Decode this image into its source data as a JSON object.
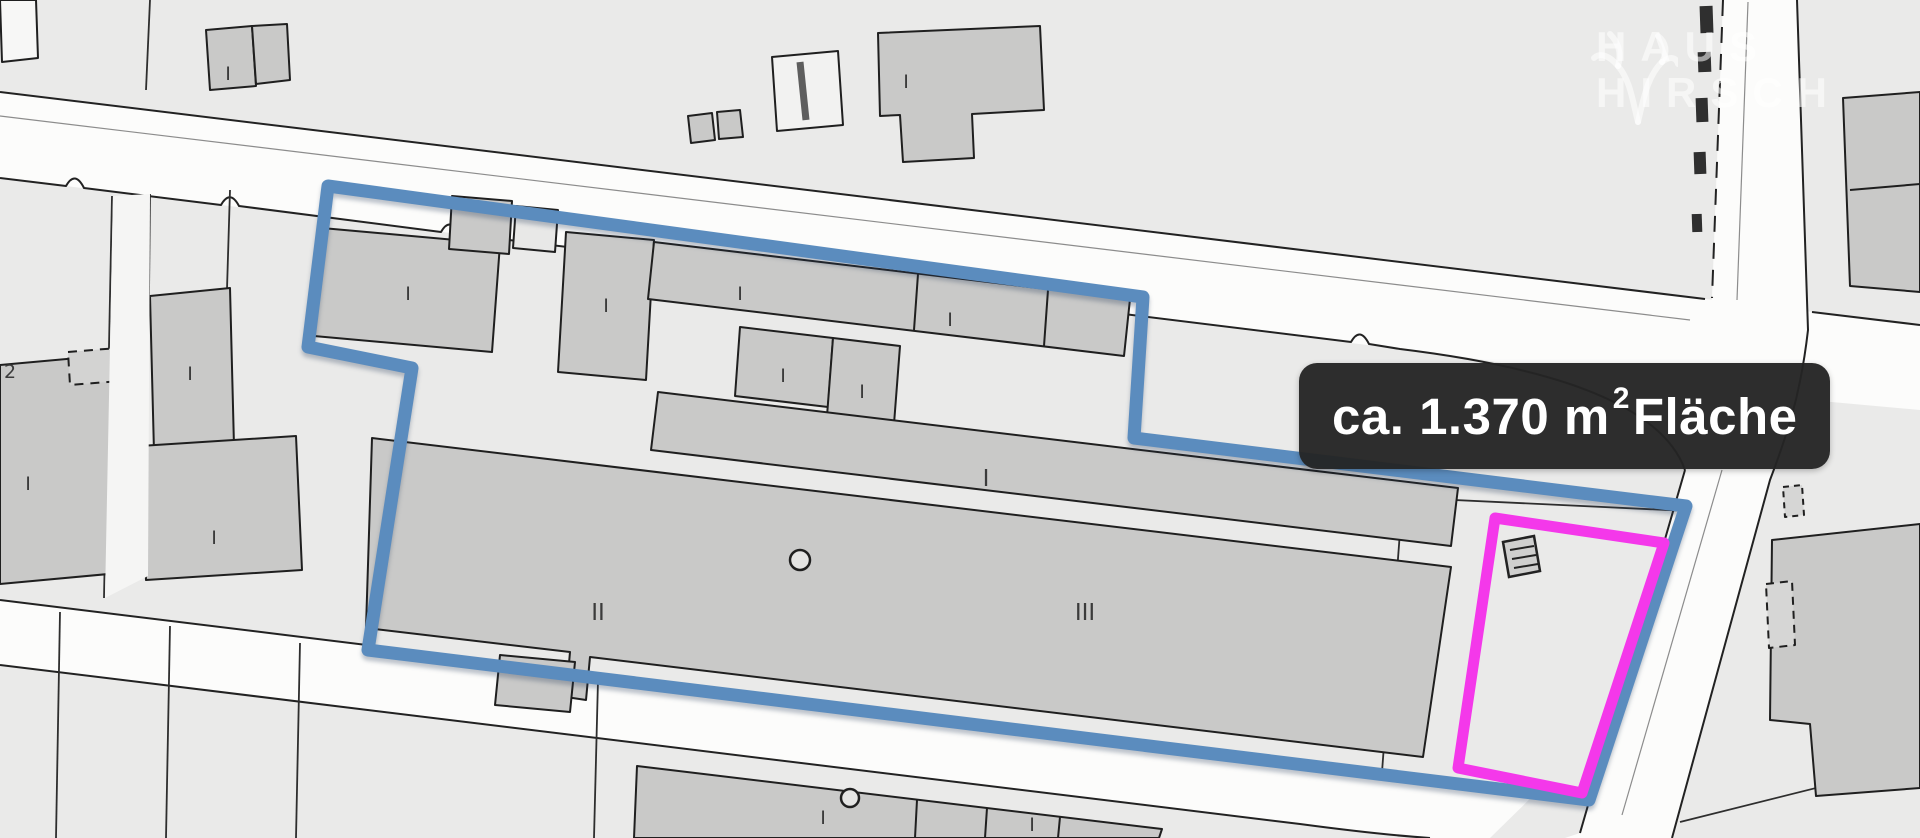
{
  "map": {
    "area_label": {
      "prefix": "ca. 1.370 m",
      "sup": "2",
      "suffix": " Fläche"
    },
    "watermark": {
      "line1": "HAUS",
      "line2": "HIRSCH"
    },
    "colors": {
      "property_outline_blue": "#5B8CBE",
      "highlight_outline_magenta": "#F438EA",
      "label_background": "#242424",
      "label_text": "#FFFFFF",
      "road_fill": "#FCFCFB",
      "building_fill": "#C9C9C8",
      "parcel_background": "#EAEAE9",
      "map_line": "#222222",
      "watermark_text": "rgba(255,255,255,0.55)"
    },
    "marks": [
      {
        "text": "I"
      },
      {
        "text": "I"
      },
      {
        "text": "I"
      },
      {
        "text": "I"
      },
      {
        "text": "I"
      },
      {
        "text": "I"
      },
      {
        "text": "I"
      },
      {
        "text": "I"
      },
      {
        "text": "I"
      },
      {
        "text": "I"
      },
      {
        "text": "I"
      },
      {
        "text": "I"
      },
      {
        "text": "II"
      },
      {
        "text": "III"
      },
      {
        "text": "I"
      },
      {
        "text": "I"
      },
      {
        "text": "2"
      }
    ]
  }
}
